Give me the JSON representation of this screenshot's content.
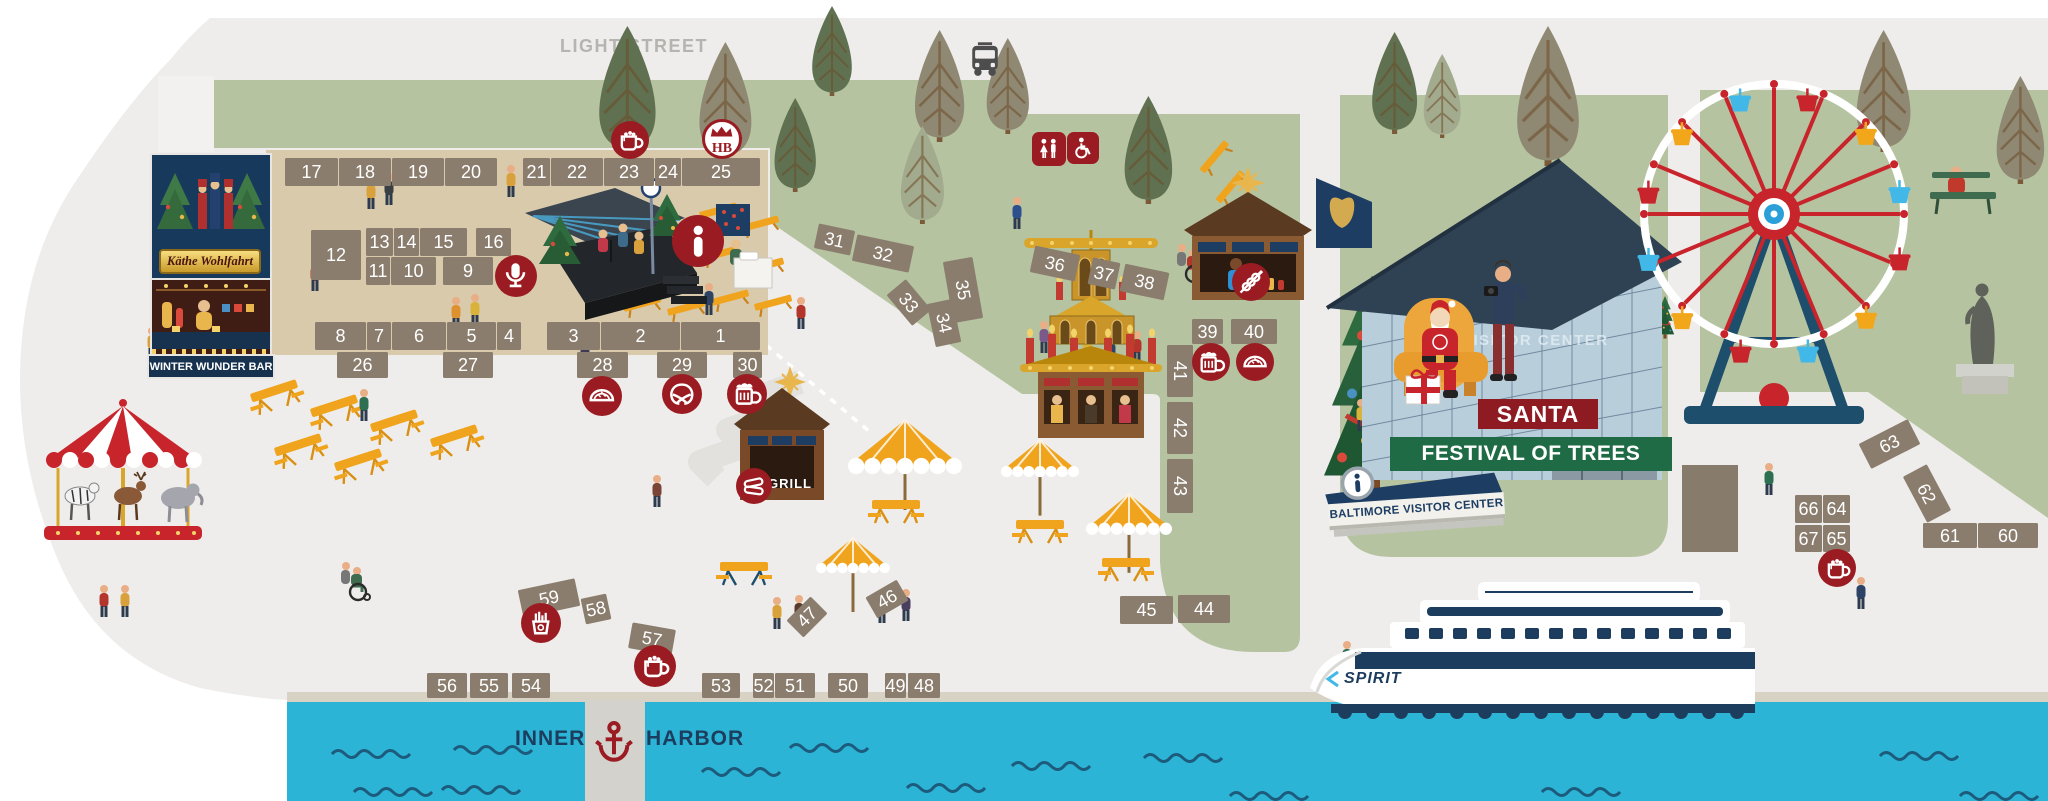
{
  "street_label": "LIGHT STREET",
  "harbor": {
    "left": "INNER",
    "right": "HARBOR"
  },
  "shop": {
    "name": "Käthe Wohlfahrt",
    "bar": "WINTER WUNDER BAR"
  },
  "food": {
    "grill": "GRILL"
  },
  "santa_area": {
    "santa": "SANTA",
    "festival": "FESTIVAL OF TREES",
    "visitor_sign": "BALTIMORE VISITOR CENTER",
    "glass_text": "VISITOR CENTER"
  },
  "boat": {
    "name": "SPIRIT"
  },
  "badges": {
    "hb": "HB"
  },
  "colors": {
    "green": "#b6c3a0",
    "market_tan": "#d9caac",
    "booth": "#8a7d6d",
    "maroon": "#9a1c22",
    "navy": "#1d3d5e",
    "water": "#2cb4d6",
    "wave": "#1d5b7d",
    "bench_yellow": "#f0a41d",
    "santa_sign_red": "#8e1b22",
    "festival_green": "#1e6b45",
    "wheel_red": "#c8242c",
    "wheel_blue": "#41b8e8",
    "road_text": "#b4b4b1"
  },
  "booths": [
    {
      "n": 1,
      "x": 681,
      "y": 322,
      "w": 79,
      "h": 28,
      "r": 0
    },
    {
      "n": 2,
      "x": 601,
      "y": 322,
      "w": 79,
      "h": 28,
      "r": 0
    },
    {
      "n": 3,
      "x": 547,
      "y": 322,
      "w": 53,
      "h": 28,
      "r": 0
    },
    {
      "n": 4,
      "x": 497,
      "y": 322,
      "w": 24,
      "h": 28,
      "r": 0
    },
    {
      "n": 5,
      "x": 447,
      "y": 322,
      "w": 49,
      "h": 28,
      "r": 0
    },
    {
      "n": 6,
      "x": 392,
      "y": 322,
      "w": 54,
      "h": 28,
      "r": 0
    },
    {
      "n": 7,
      "x": 367,
      "y": 322,
      "w": 24,
      "h": 28,
      "r": 0
    },
    {
      "n": 8,
      "x": 315,
      "y": 322,
      "w": 51,
      "h": 28,
      "r": 0
    },
    {
      "n": 9,
      "x": 443,
      "y": 257,
      "w": 50,
      "h": 28,
      "r": 0
    },
    {
      "n": 10,
      "x": 391,
      "y": 257,
      "w": 45,
      "h": 28,
      "r": 0
    },
    {
      "n": 11,
      "x": 366,
      "y": 257,
      "w": 24,
      "h": 28,
      "r": 0
    },
    {
      "n": 12,
      "x": 311,
      "y": 230,
      "w": 50,
      "h": 50,
      "r": 0
    },
    {
      "n": 13,
      "x": 366,
      "y": 228,
      "w": 27,
      "h": 28,
      "r": 0
    },
    {
      "n": 14,
      "x": 394,
      "y": 228,
      "w": 25,
      "h": 28,
      "r": 0
    },
    {
      "n": 15,
      "x": 420,
      "y": 228,
      "w": 47,
      "h": 28,
      "r": 0
    },
    {
      "n": 16,
      "x": 476,
      "y": 228,
      "w": 35,
      "h": 28,
      "r": 0
    },
    {
      "n": 17,
      "x": 285,
      "y": 158,
      "w": 53,
      "h": 28,
      "r": 0
    },
    {
      "n": 18,
      "x": 339,
      "y": 158,
      "w": 52,
      "h": 28,
      "r": 0
    },
    {
      "n": 19,
      "x": 392,
      "y": 158,
      "w": 52,
      "h": 28,
      "r": 0
    },
    {
      "n": 20,
      "x": 445,
      "y": 158,
      "w": 52,
      "h": 28,
      "r": 0
    },
    {
      "n": 21,
      "x": 523,
      "y": 158,
      "w": 27,
      "h": 28,
      "r": 0
    },
    {
      "n": 22,
      "x": 551,
      "y": 158,
      "w": 52,
      "h": 28,
      "r": 0
    },
    {
      "n": 23,
      "x": 604,
      "y": 158,
      "w": 50,
      "h": 28,
      "r": 0
    },
    {
      "n": 24,
      "x": 655,
      "y": 158,
      "w": 26,
      "h": 28,
      "r": 0
    },
    {
      "n": 25,
      "x": 682,
      "y": 158,
      "w": 78,
      "h": 28,
      "r": 0
    },
    {
      "n": 26,
      "x": 337,
      "y": 352,
      "w": 51,
      "h": 26,
      "r": 0
    },
    {
      "n": 27,
      "x": 443,
      "y": 352,
      "w": 50,
      "h": 26,
      "r": 0
    },
    {
      "n": 28,
      "x": 577,
      "y": 352,
      "w": 51,
      "h": 26,
      "r": 0
    },
    {
      "n": 29,
      "x": 657,
      "y": 352,
      "w": 50,
      "h": 26,
      "r": 0
    },
    {
      "n": 30,
      "x": 733,
      "y": 352,
      "w": 29,
      "h": 26,
      "r": 0
    },
    {
      "n": 31,
      "x": 816,
      "y": 227,
      "w": 37,
      "h": 25,
      "r": 12
    },
    {
      "n": 32,
      "x": 854,
      "y": 240,
      "w": 58,
      "h": 27,
      "r": 12
    },
    {
      "n": 33,
      "x": 889,
      "y": 290,
      "w": 40,
      "h": 25,
      "r": 50
    },
    {
      "n": 34,
      "x": 922,
      "y": 310,
      "w": 44,
      "h": 26,
      "r": 78
    },
    {
      "n": 35,
      "x": 932,
      "y": 275,
      "w": 62,
      "h": 30,
      "r": 80
    },
    {
      "n": 36,
      "x": 1032,
      "y": 250,
      "w": 46,
      "h": 27,
      "r": 12
    },
    {
      "n": 37,
      "x": 1090,
      "y": 260,
      "w": 28,
      "h": 27,
      "r": 12
    },
    {
      "n": 38,
      "x": 1122,
      "y": 268,
      "w": 45,
      "h": 28,
      "r": 12
    },
    {
      "n": 39,
      "x": 1192,
      "y": 319,
      "w": 31,
      "h": 25,
      "r": 0
    },
    {
      "n": 40,
      "x": 1231,
      "y": 319,
      "w": 46,
      "h": 25,
      "r": 0
    },
    {
      "n": 41,
      "x": 1154,
      "y": 358,
      "w": 52,
      "h": 26,
      "r": 90
    },
    {
      "n": 42,
      "x": 1154,
      "y": 415,
      "w": 52,
      "h": 26,
      "r": 90
    },
    {
      "n": 43,
      "x": 1153,
      "y": 473,
      "w": 54,
      "h": 26,
      "r": 90
    },
    {
      "n": 44,
      "x": 1178,
      "y": 595,
      "w": 52,
      "h": 28,
      "r": 0
    },
    {
      "n": 45,
      "x": 1120,
      "y": 596,
      "w": 53,
      "h": 28,
      "r": 0
    },
    {
      "n": 46,
      "x": 869,
      "y": 587,
      "w": 36,
      "h": 24,
      "r": -30
    },
    {
      "n": 47,
      "x": 790,
      "y": 605,
      "w": 34,
      "h": 24,
      "r": -45
    },
    {
      "n": 48,
      "x": 908,
      "y": 673,
      "w": 32,
      "h": 25,
      "r": 0
    },
    {
      "n": 49,
      "x": 885,
      "y": 673,
      "w": 21,
      "h": 25,
      "r": 0
    },
    {
      "n": 50,
      "x": 828,
      "y": 673,
      "w": 40,
      "h": 25,
      "r": 0
    },
    {
      "n": 51,
      "x": 775,
      "y": 673,
      "w": 40,
      "h": 25,
      "r": 0
    },
    {
      "n": 52,
      "x": 753,
      "y": 673,
      "w": 21,
      "h": 25,
      "r": 0
    },
    {
      "n": 53,
      "x": 702,
      "y": 673,
      "w": 38,
      "h": 25,
      "r": 0
    },
    {
      "n": 54,
      "x": 512,
      "y": 673,
      "w": 38,
      "h": 25,
      "r": 0
    },
    {
      "n": 55,
      "x": 470,
      "y": 673,
      "w": 38,
      "h": 25,
      "r": 0
    },
    {
      "n": 56,
      "x": 427,
      "y": 673,
      "w": 40,
      "h": 25,
      "r": 0
    },
    {
      "n": 57,
      "x": 630,
      "y": 626,
      "w": 44,
      "h": 26,
      "r": 10
    },
    {
      "n": 58,
      "x": 583,
      "y": 596,
      "w": 26,
      "h": 26,
      "r": -12
    },
    {
      "n": 59,
      "x": 520,
      "y": 584,
      "w": 58,
      "h": 28,
      "r": -12
    },
    {
      "n": 60,
      "x": 1978,
      "y": 523,
      "w": 60,
      "h": 25,
      "r": 0
    },
    {
      "n": 61,
      "x": 1923,
      "y": 523,
      "w": 54,
      "h": 25,
      "r": 0
    },
    {
      "n": 62,
      "x": 1901,
      "y": 480,
      "w": 52,
      "h": 27,
      "r": 62
    },
    {
      "n": 63,
      "x": 1862,
      "y": 430,
      "w": 55,
      "h": 28,
      "r": -27
    },
    {
      "n": 64,
      "x": 1823,
      "y": 495,
      "w": 27,
      "h": 28,
      "r": 0
    },
    {
      "n": 65,
      "x": 1823,
      "y": 525,
      "w": 27,
      "h": 27,
      "r": 0
    },
    {
      "n": 66,
      "x": 1795,
      "y": 495,
      "w": 27,
      "h": 28,
      "r": 0
    },
    {
      "n": 67,
      "x": 1795,
      "y": 525,
      "w": 27,
      "h": 27,
      "r": 0
    }
  ],
  "icons": [
    {
      "name": "hot-chocolate-icon",
      "g": "cocoa",
      "x": 630,
      "y": 140,
      "r": 19
    },
    {
      "name": "hofbrau-badge-icon",
      "g": "hb",
      "x": 722,
      "y": 139,
      "r": 20
    },
    {
      "name": "microphone-icon",
      "g": "mic",
      "x": 516,
      "y": 276,
      "r": 21
    },
    {
      "name": "info-icon",
      "g": "info",
      "x": 698,
      "y": 241,
      "r": 26
    },
    {
      "name": "empanada-icon",
      "g": "empanada",
      "x": 602,
      "y": 396,
      "r": 20
    },
    {
      "name": "pretzel-icon",
      "g": "pretzel",
      "x": 682,
      "y": 394,
      "r": 20
    },
    {
      "name": "beer-icon",
      "g": "beer",
      "x": 747,
      "y": 394,
      "r": 20
    },
    {
      "name": "sausage-grill-icon",
      "g": "sausage",
      "x": 754,
      "y": 486,
      "r": 18
    },
    {
      "name": "kebab-skewer-icon",
      "g": "kebab",
      "x": 1251,
      "y": 282,
      "r": 19
    },
    {
      "name": "beer-icon",
      "g": "beer",
      "x": 1211,
      "y": 362,
      "r": 19
    },
    {
      "name": "empanada-icon",
      "g": "empanada",
      "x": 1255,
      "y": 362,
      "r": 19
    },
    {
      "name": "fries-icon",
      "g": "fries",
      "x": 541,
      "y": 623,
      "r": 20
    },
    {
      "name": "hot-chocolate-icon",
      "g": "cocoa",
      "x": 655,
      "y": 666,
      "r": 21
    },
    {
      "name": "hot-chocolate-icon",
      "g": "cocoa",
      "x": 1837,
      "y": 568,
      "r": 19
    },
    {
      "name": "restroom-icon",
      "g": "restroom",
      "x": 1049,
      "y": 149,
      "r": 17,
      "shape": "sq"
    },
    {
      "name": "wheelchair-accessible-icon",
      "g": "accessible",
      "x": 1083,
      "y": 148,
      "r": 16,
      "shape": "sq"
    },
    {
      "name": "bus-stop-icon",
      "g": "bus",
      "x": 985,
      "y": 60,
      "r": 23,
      "shape": "plain"
    },
    {
      "name": "anchor-icon",
      "g": "anchor",
      "x": 614,
      "y": 741,
      "r": 27,
      "shape": "plain"
    }
  ]
}
